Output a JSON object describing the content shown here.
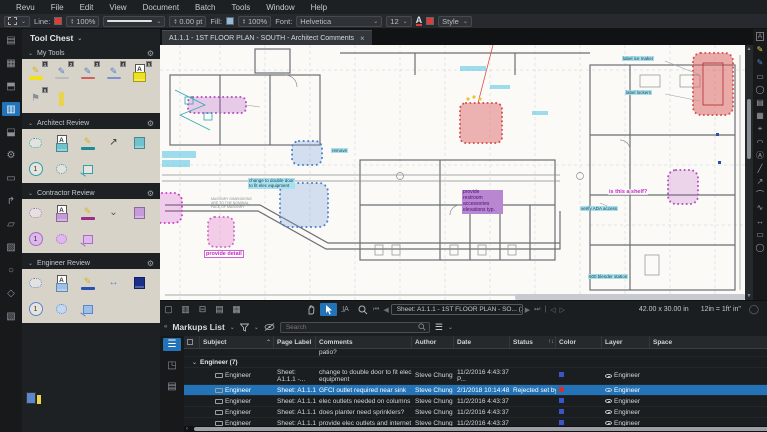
{
  "menu": {
    "items": [
      "Revu",
      "File",
      "Edit",
      "View",
      "Document",
      "Batch",
      "Tools",
      "Window",
      "Help"
    ]
  },
  "toolbar": {
    "line_label": "Line:",
    "line_opacity": "100%",
    "line_width": "0.00 pt",
    "fill_label": "Fill:",
    "fill_opacity": "100%",
    "font_label": "Font:",
    "font_name": "Helvetica",
    "font_size": "12",
    "style_label": "Style",
    "line_color": "#e03a3a",
    "fill_color": "#8fbce0",
    "font_color": "#e03a3a"
  },
  "toolchest": {
    "title": "Tool Chest",
    "badges": [
      "1",
      "2",
      "3",
      "4",
      "5",
      "6"
    ],
    "stamp_number": "1",
    "sections": [
      {
        "label": "My Tools"
      },
      {
        "label": "Architect Review"
      },
      {
        "label": "Contractor Review"
      },
      {
        "label": "Engineer Review"
      }
    ]
  },
  "document_tab": {
    "title": "A1.1.1 - 1ST FLOOR PLAN - SOUTH - Architect Comments",
    "close": "×"
  },
  "canvas_notes": {
    "double_door": "change to double door\nto fit elec equipment",
    "remove": "remove",
    "provide_detail": "provide detail",
    "masonry": "MASONRY DIMENSIONS\nARE TO THE NOMINAL\nFACE OF MASONRY",
    "restroom": "provide\nrestroom\naccessories\nelevations typ.",
    "ada": "verify ADA access",
    "shelf": "is this a shelf?",
    "ice_maker": "label ice maker",
    "lockers": "label lockers",
    "blender": "600 blender station"
  },
  "navbar": {
    "sheet_nav": "Sheet: A1.1.1 - 1ST FLOOR PLAN - SO... (1 of 1)"
  },
  "statusbar": {
    "page_size": "42.00 x 30.00 in",
    "scale": "12in = 1ft' in\""
  },
  "markups_panel": {
    "title": "Markups List",
    "search_placeholder": "Search",
    "partial_comment": "patio?",
    "group_label": "Engineer (7)",
    "columns": {
      "subject": "Subject",
      "page": "Page Label",
      "comments": "Comments",
      "author": "Author",
      "date": "Date",
      "status": "Status",
      "color": "Color",
      "layer": "Layer",
      "space": "Space"
    },
    "rows": [
      {
        "subject": "Engineer",
        "page": "Sheet: A1.1.1 -...",
        "comment": "change to double door to fit elec equipment",
        "author": "Steve Chung",
        "date": "11/2/2016 4:43:37 P...",
        "status": "",
        "color": "#3a55cc",
        "layer": "Engineer"
      },
      {
        "subject": "Engineer",
        "page": "Sheet: A1.1.1 -...",
        "comment": "GFCI outlet required near sink",
        "author": "Steve Chung",
        "date": "2/1/2018 10:14:48 A...",
        "status": "Rejected set by Ima...",
        "color": "#d03030",
        "layer": "Engineer"
      },
      {
        "subject": "Engineer",
        "page": "Sheet: A1.1.1 -...",
        "comment": "elec outlets needed on columns",
        "author": "Steve Chung",
        "date": "11/2/2016 4:43:37 P...",
        "status": "",
        "color": "#3a55cc",
        "layer": "Engineer"
      },
      {
        "subject": "Engineer",
        "page": "Sheet: A1.1.1 -...",
        "comment": "does planter need sprinklers?",
        "author": "Steve Chung",
        "date": "11/2/2016 4:43:37 P...",
        "status": "",
        "color": "#3a55cc",
        "layer": "Engineer"
      },
      {
        "subject": "Engineer",
        "page": "Sheet: A1.1.1 -...",
        "comment": "provide elec outlets and internet at",
        "author": "Steve Chung",
        "date": "11/2/2016 4:43:37 P...",
        "status": "",
        "color": "#3a55cc",
        "layer": "Engineer"
      }
    ]
  }
}
